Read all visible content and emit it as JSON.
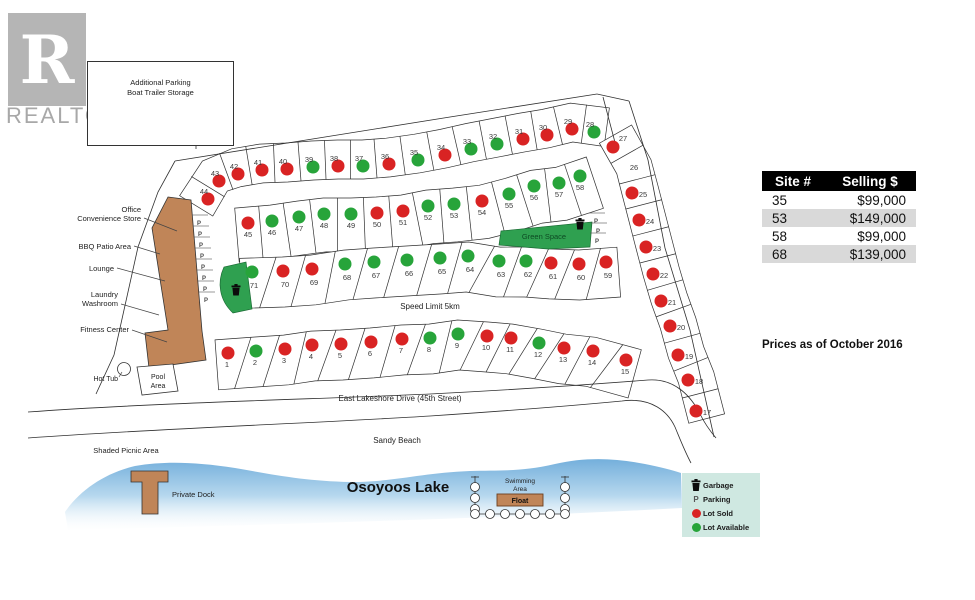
{
  "branding": {
    "logo_letter": "R",
    "logo_text": "REALTOR",
    "registered": "®"
  },
  "parking_box": {
    "line1": "Additional Parking",
    "line2": "Boat Trailer Storage"
  },
  "price_table": {
    "col1": "Site #",
    "col2": "Selling $",
    "rows": [
      {
        "site": "35",
        "price": "$99,000"
      },
      {
        "site": "53",
        "price": "$149,000"
      },
      {
        "site": "58",
        "price": "$99,000"
      },
      {
        "site": "68",
        "price": "$139,000"
      }
    ],
    "note": "Prices as of October 2016"
  },
  "legend": {
    "garbage": "Garbage",
    "parking": "Parking",
    "sold": "Lot Sold",
    "available": "Lot Available"
  },
  "colors": {
    "sold": "#d92323",
    "available": "#27a43a",
    "building": "#c08558",
    "green_space": "#2fa050",
    "lake_top": "#72aedb",
    "legend_bg": "#cfe8e1",
    "table_alt": "#d9d9d9"
  },
  "map": {
    "street_labels": [
      {
        "id": "speed-limit",
        "text": "Speed Limit 5km",
        "x": 430,
        "y": 309,
        "size": 8
      },
      {
        "id": "east-lakeshore-drive",
        "text": "East Lakeshore Drive (45th Street)",
        "x": 400,
        "y": 401,
        "size": 8
      },
      {
        "id": "sandy-beach",
        "text": "Sandy Beach",
        "x": 397,
        "y": 443,
        "size": 8
      },
      {
        "id": "osoyoos-lake",
        "text": "Osoyoos Lake",
        "x": 398,
        "y": 492,
        "size": 15,
        "bold": true
      },
      {
        "id": "shaded-picnic-area",
        "text": "Shaded Picnic Area",
        "x": 126,
        "y": 453,
        "size": 7.5
      },
      {
        "id": "green-space",
        "text": "Green Space",
        "x": 544,
        "y": 239,
        "size": 7.5,
        "color": "dark-green"
      },
      {
        "id": "swimming-area-1",
        "text": "Swimming",
        "x": 520,
        "y": 483,
        "size": 6.5
      },
      {
        "id": "swimming-area-2",
        "text": "Area",
        "x": 520,
        "y": 491,
        "size": 6.5
      },
      {
        "id": "float",
        "text": "Float",
        "x": 520,
        "y": 503,
        "size": 7,
        "bold": true
      },
      {
        "id": "private-dock",
        "text": "Private Dock",
        "x": 172,
        "y": 497,
        "size": 7.5,
        "anchor": "start"
      },
      {
        "id": "pool-area-1",
        "text": "Pool",
        "x": 158,
        "y": 379,
        "size": 7
      },
      {
        "id": "pool-area-2",
        "text": "Area",
        "x": 158,
        "y": 388,
        "size": 7
      },
      {
        "id": "hot-tub",
        "text": "Hot Tub",
        "x": 118,
        "y": 381,
        "size": 7,
        "anchor": "end"
      }
    ],
    "facilities": [
      {
        "id": "office-convenience-store",
        "lines": [
          "Office",
          "Convenience Store"
        ],
        "tx": 141,
        "ty": 212,
        "x1": 144,
        "y1": 218,
        "x2": 177,
        "y2": 231
      },
      {
        "id": "bbq-patio-area",
        "lines": [
          "BBQ Patio Area"
        ],
        "tx": 131,
        "ty": 249,
        "x1": 134,
        "y1": 246,
        "x2": 160,
        "y2": 254
      },
      {
        "id": "lounge",
        "lines": [
          "Lounge"
        ],
        "tx": 114,
        "ty": 271,
        "x1": 117,
        "y1": 268,
        "x2": 165,
        "y2": 281
      },
      {
        "id": "laundry-washroom",
        "lines": [
          "Laundry",
          "Washroom"
        ],
        "tx": 118,
        "ty": 297,
        "x1": 121,
        "y1": 304,
        "x2": 159,
        "y2": 315
      },
      {
        "id": "fitness-center",
        "lines": [
          "Fitness Center"
        ],
        "tx": 129,
        "ty": 332,
        "x1": 132,
        "y1": 330,
        "x2": 167,
        "y2": 342
      }
    ],
    "rows": [
      {
        "id": "top",
        "lots": [
          {
            "n": "44",
            "x": 208,
            "y": 199,
            "s": "sold"
          },
          {
            "n": "43",
            "x": 219,
            "y": 181,
            "s": "sold"
          },
          {
            "n": "42",
            "x": 238,
            "y": 174,
            "s": "sold"
          },
          {
            "n": "41",
            "x": 262,
            "y": 170,
            "s": "sold"
          },
          {
            "n": "40",
            "x": 287,
            "y": 169,
            "s": "sold"
          },
          {
            "n": "39",
            "x": 313,
            "y": 167,
            "s": "available"
          },
          {
            "n": "38",
            "x": 338,
            "y": 166,
            "s": "sold"
          },
          {
            "n": "37",
            "x": 363,
            "y": 166,
            "s": "available"
          },
          {
            "n": "36",
            "x": 389,
            "y": 164,
            "s": "sold"
          },
          {
            "n": "35",
            "x": 418,
            "y": 160,
            "s": "available"
          },
          {
            "n": "34",
            "x": 445,
            "y": 155,
            "s": "sold"
          },
          {
            "n": "33",
            "x": 471,
            "y": 149,
            "s": "available"
          },
          {
            "n": "32",
            "x": 497,
            "y": 144,
            "s": "available"
          },
          {
            "n": "31",
            "x": 523,
            "y": 139,
            "s": "sold"
          },
          {
            "n": "30",
            "x": 547,
            "y": 135,
            "s": "sold"
          },
          {
            "n": "29",
            "x": 572,
            "y": 129,
            "s": "sold"
          },
          {
            "n": "28",
            "x": 594,
            "y": 132,
            "s": "available"
          }
        ]
      },
      {
        "id": "right",
        "lots": [
          {
            "n": "27",
            "x": 613,
            "y": 147,
            "s": "sold",
            "lx": 623,
            "ly": 138
          },
          {
            "n": "26",
            "x": 626,
            "y": 170,
            "s": "none",
            "lx": 634,
            "ly": 167
          },
          {
            "n": "25",
            "x": 632,
            "y": 193,
            "s": "sold"
          },
          {
            "n": "24",
            "x": 639,
            "y": 220,
            "s": "sold"
          },
          {
            "n": "23",
            "x": 646,
            "y": 247,
            "s": "sold"
          },
          {
            "n": "22",
            "x": 653,
            "y": 274,
            "s": "sold"
          },
          {
            "n": "21",
            "x": 661,
            "y": 301,
            "s": "sold"
          },
          {
            "n": "20",
            "x": 670,
            "y": 326,
            "s": "sold"
          },
          {
            "n": "19",
            "x": 678,
            "y": 355,
            "s": "sold"
          },
          {
            "n": "18",
            "x": 688,
            "y": 380,
            "s": "sold"
          },
          {
            "n": "17",
            "x": 696,
            "y": 411,
            "s": "sold"
          }
        ]
      },
      {
        "id": "mid",
        "lots": [
          {
            "n": "45",
            "x": 248,
            "y": 223,
            "s": "sold"
          },
          {
            "n": "46",
            "x": 272,
            "y": 221,
            "s": "available"
          },
          {
            "n": "47",
            "x": 299,
            "y": 217,
            "s": "available"
          },
          {
            "n": "48",
            "x": 324,
            "y": 214,
            "s": "available"
          },
          {
            "n": "49",
            "x": 351,
            "y": 214,
            "s": "available"
          },
          {
            "n": "50",
            "x": 377,
            "y": 213,
            "s": "sold"
          },
          {
            "n": "51",
            "x": 403,
            "y": 211,
            "s": "sold"
          },
          {
            "n": "52",
            "x": 428,
            "y": 206,
            "s": "available"
          },
          {
            "n": "53",
            "x": 454,
            "y": 204,
            "s": "available"
          },
          {
            "n": "54",
            "x": 482,
            "y": 201,
            "s": "sold"
          },
          {
            "n": "55",
            "x": 509,
            "y": 194,
            "s": "available"
          },
          {
            "n": "56",
            "x": 534,
            "y": 186,
            "s": "available"
          },
          {
            "n": "57",
            "x": 559,
            "y": 183,
            "s": "available"
          },
          {
            "n": "58",
            "x": 580,
            "y": 176,
            "s": "available"
          }
        ]
      },
      {
        "id": "third",
        "lots": [
          {
            "n": "71",
            "x": 252,
            "y": 272,
            "s": "available"
          },
          {
            "n": "70",
            "x": 283,
            "y": 271,
            "s": "sold"
          },
          {
            "n": "69",
            "x": 312,
            "y": 269,
            "s": "sold"
          },
          {
            "n": "68",
            "x": 345,
            "y": 264,
            "s": "available"
          },
          {
            "n": "67",
            "x": 374,
            "y": 262,
            "s": "available"
          },
          {
            "n": "66",
            "x": 407,
            "y": 260,
            "s": "available"
          },
          {
            "n": "65",
            "x": 440,
            "y": 258,
            "s": "available"
          },
          {
            "n": "64",
            "x": 468,
            "y": 256,
            "s": "available"
          },
          {
            "n": "63",
            "x": 499,
            "y": 261,
            "s": "available"
          },
          {
            "n": "62",
            "x": 526,
            "y": 261,
            "s": "available"
          },
          {
            "n": "61",
            "x": 551,
            "y": 263,
            "s": "sold"
          },
          {
            "n": "60",
            "x": 579,
            "y": 264,
            "s": "sold"
          },
          {
            "n": "59",
            "x": 606,
            "y": 262,
            "s": "sold"
          }
        ]
      },
      {
        "id": "bottom",
        "lots": [
          {
            "n": "1",
            "x": 228,
            "y": 353,
            "s": "sold"
          },
          {
            "n": "2",
            "x": 256,
            "y": 351,
            "s": "available"
          },
          {
            "n": "3",
            "x": 285,
            "y": 349,
            "s": "sold"
          },
          {
            "n": "4",
            "x": 312,
            "y": 345,
            "s": "sold"
          },
          {
            "n": "5",
            "x": 341,
            "y": 344,
            "s": "sold"
          },
          {
            "n": "6",
            "x": 371,
            "y": 342,
            "s": "sold"
          },
          {
            "n": "7",
            "x": 402,
            "y": 339,
            "s": "sold"
          },
          {
            "n": "8",
            "x": 430,
            "y": 338,
            "s": "available"
          },
          {
            "n": "9",
            "x": 458,
            "y": 334,
            "s": "available"
          },
          {
            "n": "10",
            "x": 487,
            "y": 336,
            "s": "sold"
          },
          {
            "n": "11",
            "x": 511,
            "y": 338,
            "s": "sold"
          },
          {
            "n": "12",
            "x": 539,
            "y": 343,
            "s": "available"
          },
          {
            "n": "13",
            "x": 564,
            "y": 348,
            "s": "sold"
          },
          {
            "n": "14",
            "x": 593,
            "y": 351,
            "s": "sold"
          },
          {
            "n": "15",
            "x": 626,
            "y": 360,
            "s": "sold"
          }
        ]
      }
    ],
    "parking_marks": [
      {
        "x": 199,
        "y": 223
      },
      {
        "x": 200,
        "y": 234
      },
      {
        "x": 201,
        "y": 245
      },
      {
        "x": 202,
        "y": 256
      },
      {
        "x": 203,
        "y": 267
      },
      {
        "x": 204,
        "y": 278
      },
      {
        "x": 205,
        "y": 289
      },
      {
        "x": 206,
        "y": 300
      },
      {
        "x": 596,
        "y": 221
      },
      {
        "x": 598,
        "y": 231
      },
      {
        "x": 597,
        "y": 241
      }
    ],
    "garbage_marks": [
      {
        "x": 236,
        "y": 291
      },
      {
        "x": 580,
        "y": 225
      }
    ]
  }
}
